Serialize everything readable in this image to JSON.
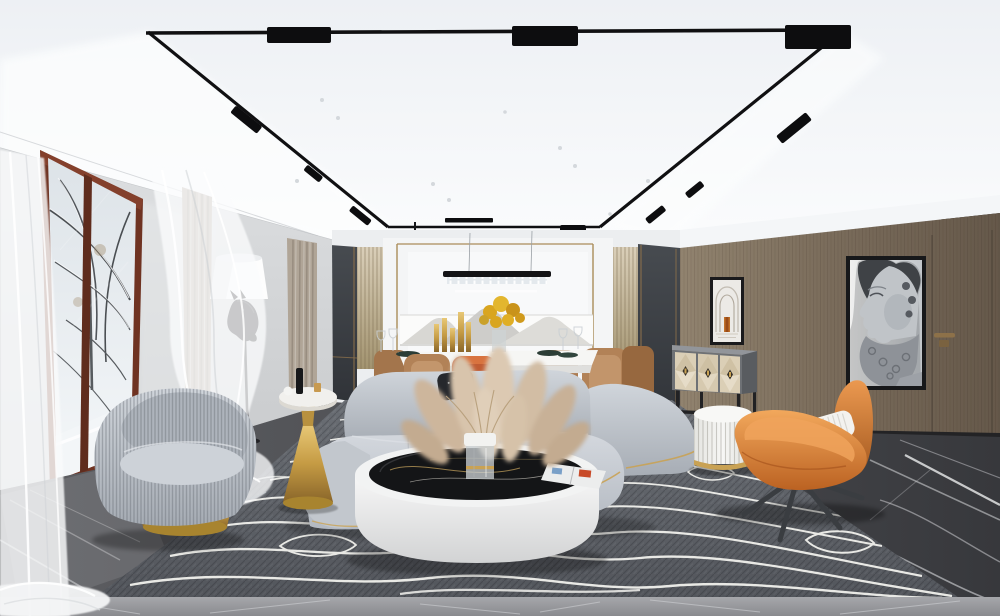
{
  "meta": {
    "title": "Modern luxury living-dining room interior render (winter)",
    "width_px": 1000,
    "height_px": 616
  },
  "scene": {
    "description": "Photorealistic 3D render of a modern living room with curved grey sofa, round coffee table with pampas grass, orange sculptural lounge chair, dining area, snowy window view, horse floor lamp, Greek statue artwork on brown wood wall, topographic-pattern rug on dark marble floor",
    "areas": [
      "ceiling with black magnetic track lighting",
      "window wall with snowy trees outside",
      "dining area",
      "living area",
      "brown wood feature wall with concealed door"
    ]
  },
  "palette": {
    "ceiling": "#f2f4f7",
    "track_black": "#101012",
    "wall_gray": "#d5d7d9",
    "window_frame_brown": "#6f3322",
    "snow_view": "#e6ebef",
    "sheer_curtain": "#ffffff",
    "taupe_curtain": "#b3a89b",
    "charcoal_panel": "#3c4045",
    "fluted_panel": "#cfc2aa",
    "gold_trim": "#a8895a",
    "brown_wall": "#7d6f5f",
    "sofa_gray": "#bfc5cc",
    "pillow_black": "#26282c",
    "coffee_table_white": "#f0f1f1",
    "marble_top_black": "#141517",
    "pampas_beige": "#d2bfa7",
    "armchair_gray": "#b7bdc5",
    "gold_metal": "#c59b44",
    "pouf_white": "#f1f1ef",
    "orange_chair": "#dd8640",
    "dining_chair_tan": "#b08157",
    "accent_rust": "#c05c33",
    "flowers_yellow": "#d9a51f",
    "rug_gray": "#60646a",
    "rug_contour_lines": "#e9e9e5",
    "floor_marble_dark": "#46484c",
    "floor_marble_light": "#97989c",
    "statue_art_gray": "#aeb2b8"
  },
  "objects": {
    "ceiling": "white ceiling with recessed cove",
    "track-lighting": "black rectangular magnetic track with linear spot fixtures",
    "recessed-spotlights": "small round ceiling spots",
    "linear-pendant": "black linear crystal pendant over dining table",
    "window": "floor window with red-brown frame, snowy trees and snow ground outside",
    "sheer-curtains": "white translucent flowing sheers",
    "taupe-curtains": "beige-taupe drapery panels",
    "floor-lamp-horse": "black horse-head floor lamp with white cone shade",
    "armchair-swivel": "grey ribbed velvet swivel armchair on gold base",
    "side-table-gold": "gold pedestal side table with white marble top, black bottle decor",
    "dining-table": "white marble dining table with gold candlesticks and yellow flowers",
    "dining-chairs": "tan upholstered dining chairs, one rust-orange cover",
    "dining-wall": "white back wall with gold trim, mountain art band, fluted and charcoal side panels",
    "sofa-curved": "light grey curved modular sofa with gold base piping and black pillow",
    "coffee-table": "round white drum coffee table with black marble inset top",
    "vase-pampas": "glass vase with gold ring and pampas grass plumes",
    "magazine": "open magazine on table top",
    "pouf": "white fluted drum pouf with gold base ring",
    "lounge-chair-orange": "orange leather petal lounge chair with white ribbed cushion and dark star legs",
    "console-sideboard": "grey sideboard with cream diamond-marquetry doors on black metal base",
    "art-greek-statue": "large black-framed artwork of classical bearded statue profile",
    "art-arch": "small black-framed artwork of white arches with orange accent",
    "door-concealed": "flush concealed door with bronze handle in brown wood wall",
    "brown-wall": "vertical-grain brown wood feature wall",
    "area-rug": "grey rug with white topographic contour lines",
    "floor-marble": "dark grey marble floor with white veining"
  }
}
